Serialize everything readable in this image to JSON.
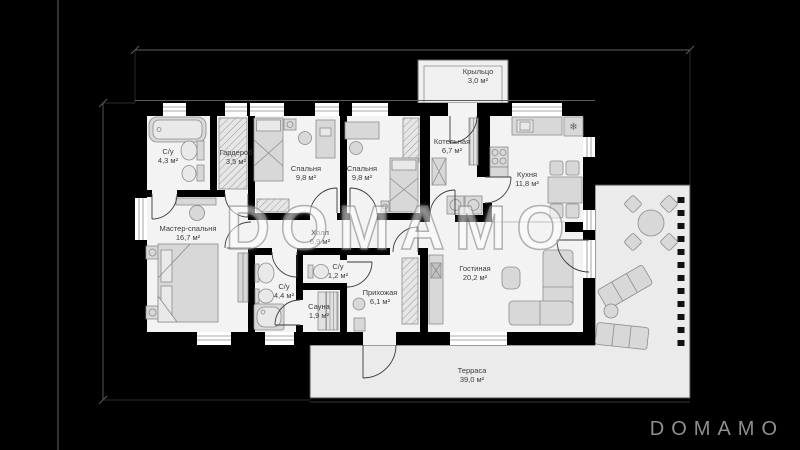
{
  "watermark": "DOMAMO",
  "logo": "DOMAMO",
  "icons": {
    "fridge": "❄"
  },
  "colors": {
    "background": "#000000",
    "floor": "#f3f3f3",
    "terrace_floor": "#ebebeb",
    "wall": "#000000",
    "furniture": "#d8d8d8",
    "label_text": "#3c3c3c",
    "logo_text": "#8f8f8f"
  },
  "rooms": [
    {
      "name": "С/у",
      "area": "4,3 м²"
    },
    {
      "name": "Гардероб",
      "area": "3,5 м²"
    },
    {
      "name": "Спальня",
      "area": "9,8 м²"
    },
    {
      "name": "Спальня",
      "area": "9,8 м²"
    },
    {
      "name": "Котельная",
      "area": "6,7 м²"
    },
    {
      "name": "Крыльцо",
      "area": "3,0 м²"
    },
    {
      "name": "Кухня",
      "area": "11,8 м²"
    },
    {
      "name": "Мастер-спальня",
      "area": "16,7 м²"
    },
    {
      "name": "Холл",
      "area": "6,9 м²"
    },
    {
      "name": "С/у",
      "area": "1,2 м²"
    },
    {
      "name": "С/у",
      "area": "4,4 м²"
    },
    {
      "name": "Сауна",
      "area": "1,9 м²"
    },
    {
      "name": "Прихожая",
      "area": "6,1 м²"
    },
    {
      "name": "Гостиная",
      "area": "20,2 м²"
    },
    {
      "name": "Терраса",
      "area": "39,0 м²"
    }
  ]
}
